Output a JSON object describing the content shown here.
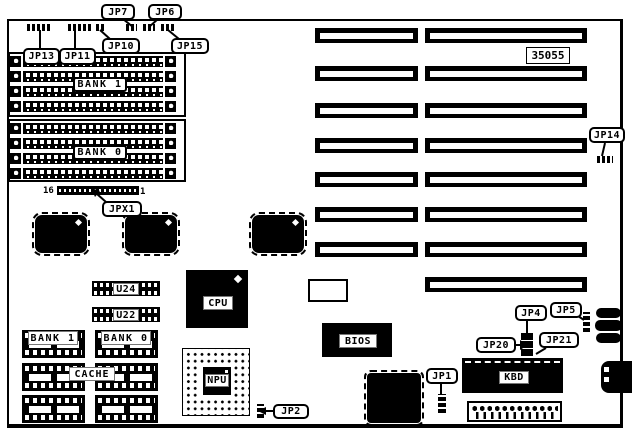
{
  "part_number": "35055",
  "labels": {
    "jp1": "JP1",
    "jp2": "JP2",
    "jp4": "JP4",
    "jp5": "JP5",
    "jp6": "JP6",
    "jp7": "JP7",
    "jp10": "JP10",
    "jp11": "JP11",
    "jp13": "JP13",
    "jp14": "JP14",
    "jp15": "JP15",
    "jp20": "JP20",
    "jp21": "JP21",
    "jpx1": "JPX1"
  },
  "memory": {
    "bank1": "BANK 1",
    "bank0": "BANK 0",
    "pin16": "16",
    "pin1": "1"
  },
  "cache": {
    "title": "CACHE",
    "bank1": "BANK 1",
    "bank0": "BANK 0"
  },
  "chips": {
    "u24": "U24",
    "u22": "U22",
    "cpu": "CPU",
    "npu": "NPU",
    "bios": "BIOS",
    "kbd": "KBD"
  }
}
